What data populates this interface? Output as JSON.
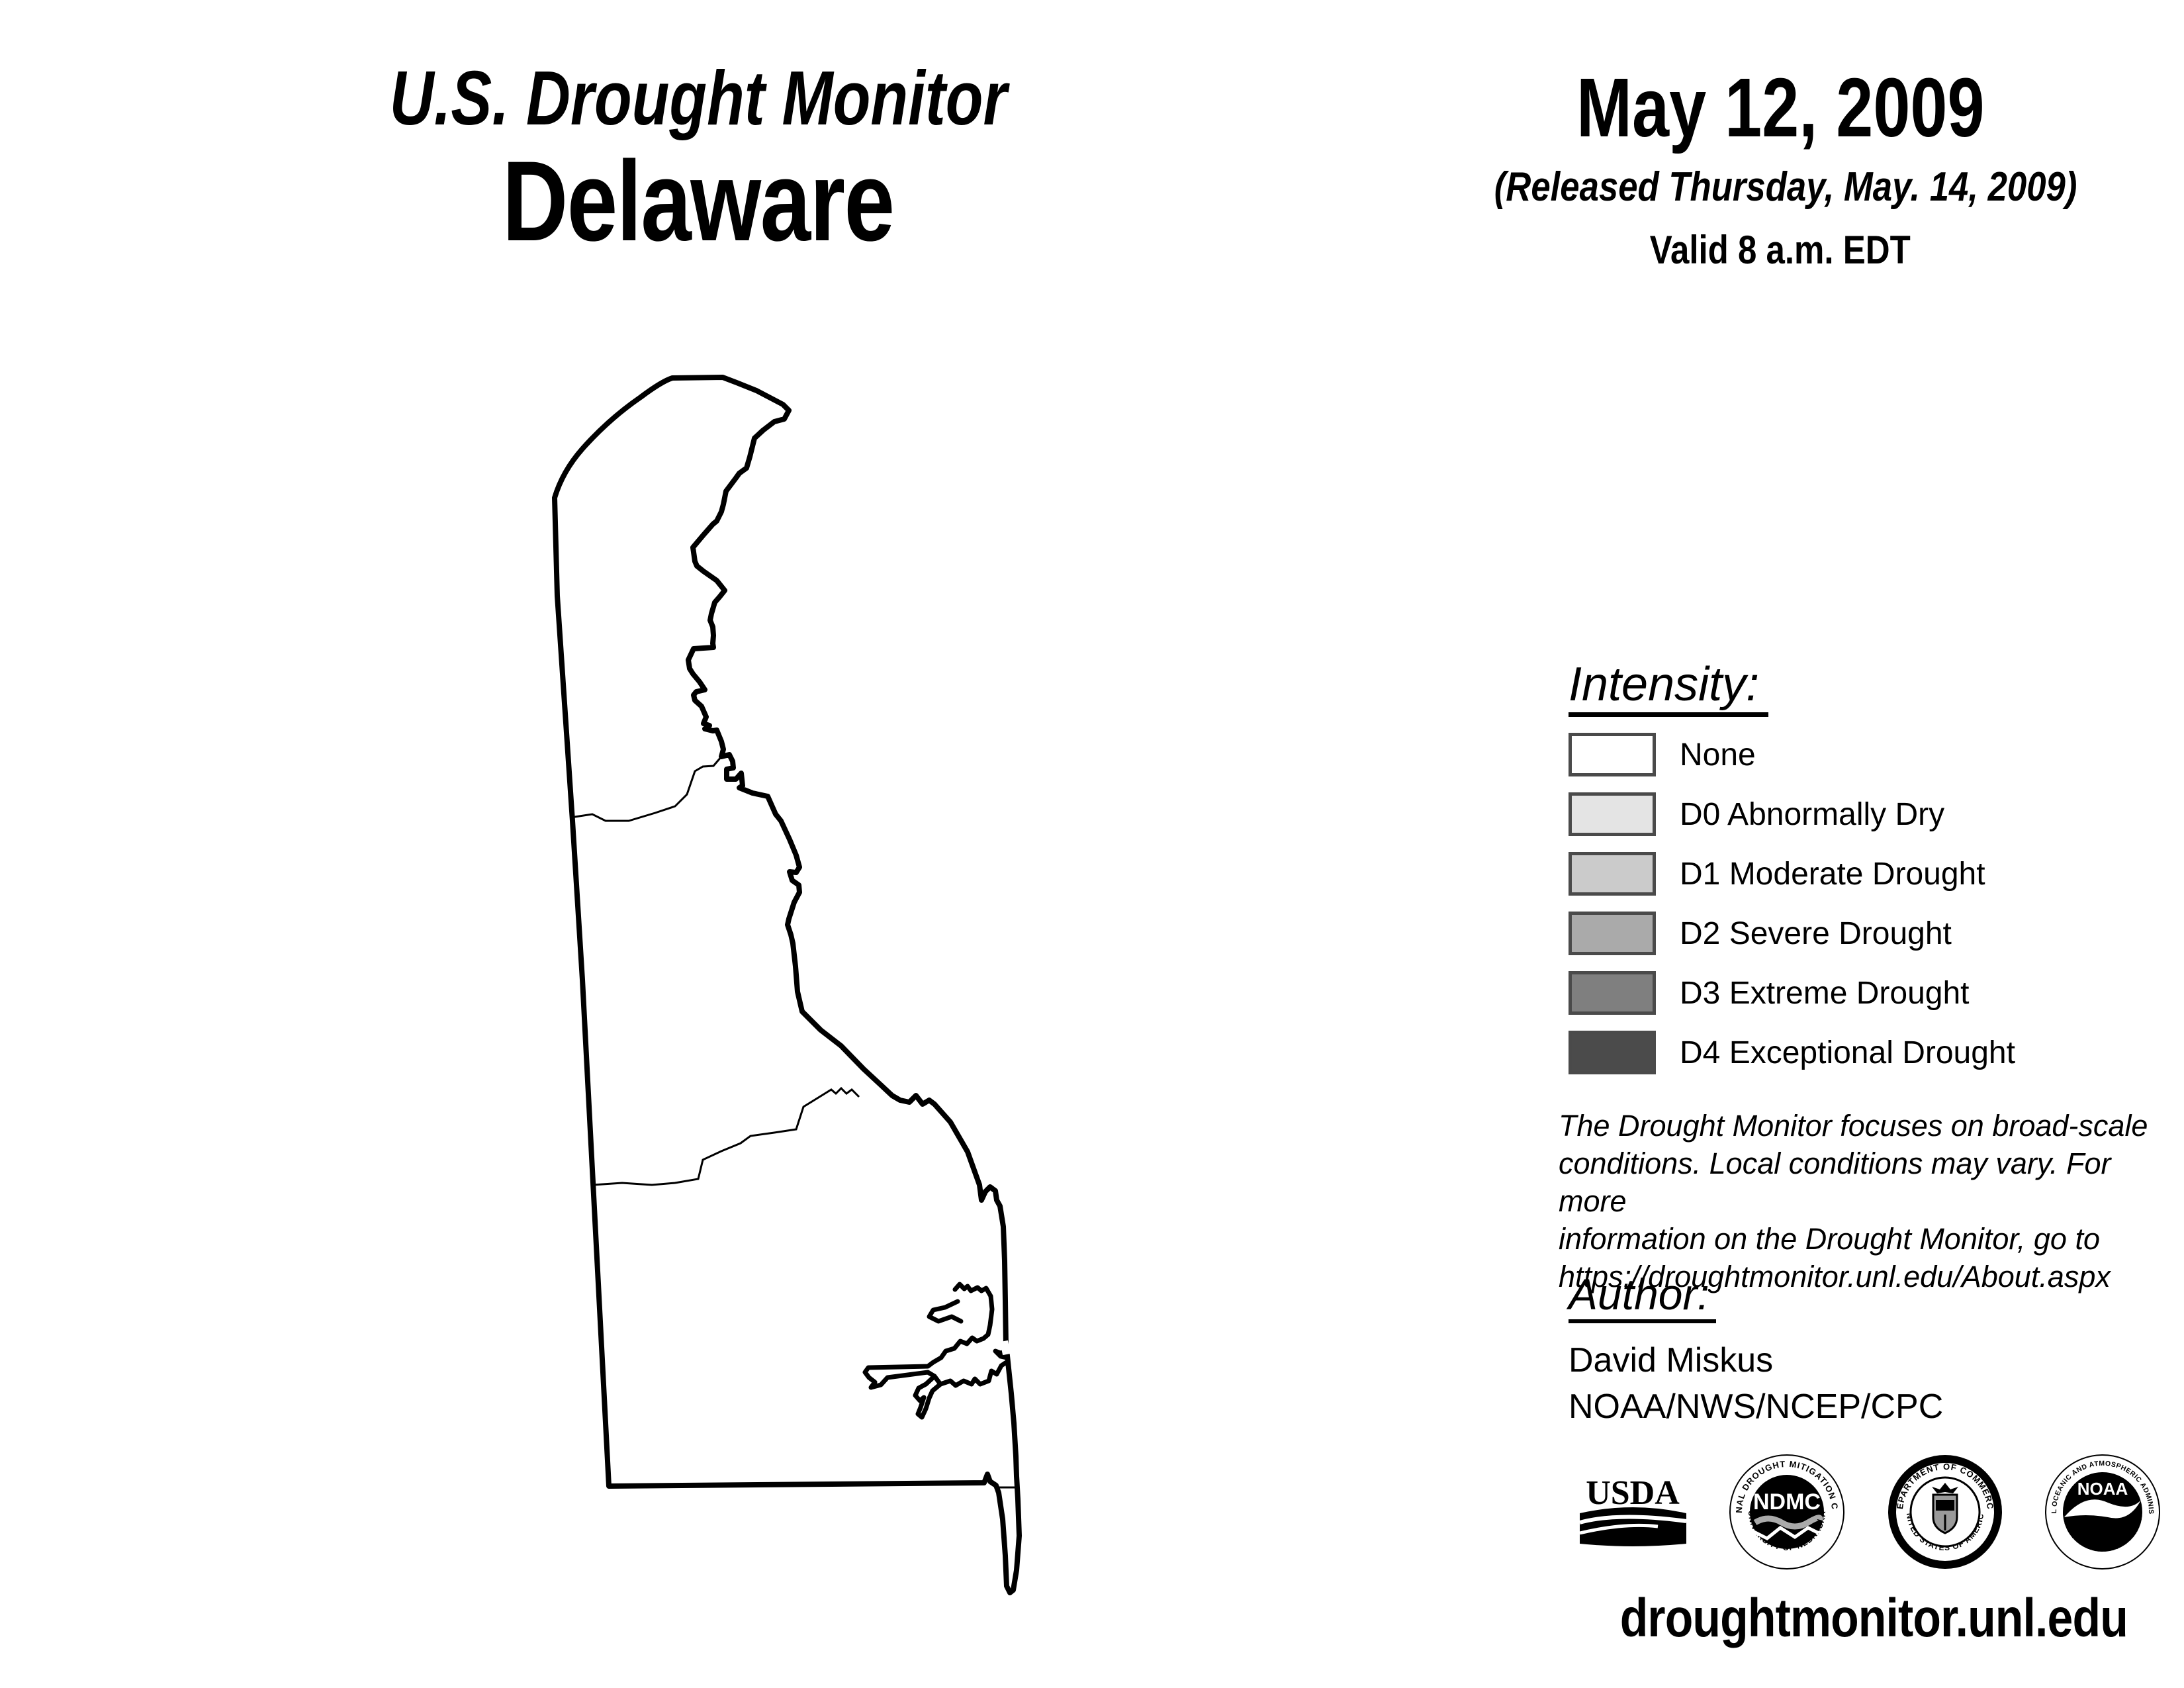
{
  "header": {
    "title_line1": "U.S. Drought Monitor",
    "title_line2": "Delaware"
  },
  "date_block": {
    "date": "May 12, 2009",
    "released": "(Released Thursday, May. 14, 2009)",
    "valid": "Valid 8 a.m. EDT"
  },
  "legend": {
    "heading": "Intensity:",
    "swatch_border_color": "#4a4a4a",
    "items": [
      {
        "label": "None",
        "color": "#ffffff"
      },
      {
        "label": "D0 Abnormally Dry",
        "color": "#e4e4e4"
      },
      {
        "label": "D1 Moderate Drought",
        "color": "#cbcbcb"
      },
      {
        "label": "D2 Severe Drought",
        "color": "#aaaaaa"
      },
      {
        "label": "D3 Extreme Drought",
        "color": "#7f7f7f"
      },
      {
        "label": "D4 Exceptional Drought",
        "color": "#4b4b4b"
      }
    ]
  },
  "disclaimer": {
    "lines": [
      "The Drought Monitor focuses on broad-scale",
      "conditions. Local conditions may vary. For more",
      "information on the Drought Monitor, go to",
      "https://droughtmonitor.unl.edu/About.aspx"
    ]
  },
  "author_block": {
    "heading": "Author:",
    "name": "David Miskus",
    "agency": "NOAA/NWS/NCEP/CPC"
  },
  "logos": {
    "usda_label": "USDA",
    "ndmc_label": "NDMC",
    "ndmc_ring_top": "NATIONAL DROUGHT MITIGATION CENTER",
    "ndmc_ring_bottom": "UNIVERSITY OF NEBRASKA",
    "doc_ring_top": "DEPARTMENT OF COMMERCE",
    "doc_ring_bottom": "UNITED STATES OF AMERICA",
    "noaa_label": "NOAA",
    "noaa_ring_top": "NATIONAL OCEANIC AND ATMOSPHERIC ADMINISTRATION",
    "noaa_ring_bottom": "U.S. DEPARTMENT OF COMMERCE"
  },
  "footer": {
    "url": "droughtmonitor.unl.edu"
  }
}
